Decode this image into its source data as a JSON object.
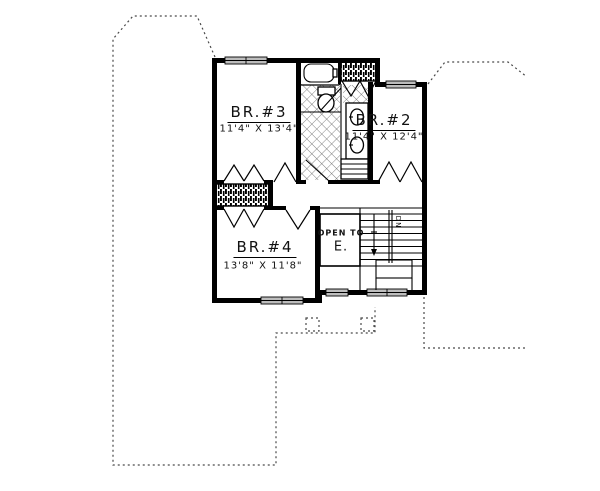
{
  "plan": {
    "rooms": [
      {
        "name": "BR.#3",
        "dims": "11'4\" X 13'4\""
      },
      {
        "name": "BR.#2",
        "dims": "11'4\" X 12'4\""
      },
      {
        "name": "BR.#4",
        "dims": "13'8\" X 11'8\""
      }
    ],
    "open_area": {
      "line1": "OPEN TO",
      "line2": "E."
    },
    "stairs": {
      "label": "DN"
    },
    "colors": {
      "wall": "#000000",
      "window_fill": "#bdbdbd",
      "dashed_line": "#4a4a4a"
    }
  }
}
